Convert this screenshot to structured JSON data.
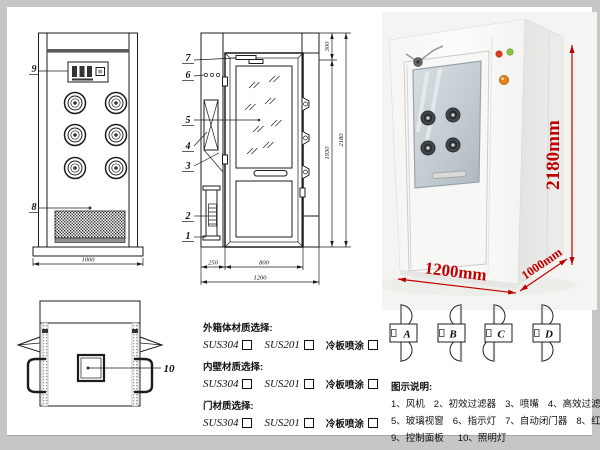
{
  "front_view": {
    "callout_9": "9",
    "callout_8": "8",
    "dim_width": "1000"
  },
  "side_view": {
    "callouts": {
      "c7": "7",
      "c6": "6",
      "c5": "5",
      "c4": "4",
      "c3": "3",
      "c2": "2",
      "c1": "1"
    },
    "dims": {
      "top": "300",
      "mid": "1930",
      "total_h": "2180",
      "left": "250",
      "door": "800",
      "total_w": "1200"
    }
  },
  "top_view": {
    "callout_10": "10"
  },
  "photo": {
    "height_label": "2180mm",
    "width_label": "1200mm",
    "depth_label": "1000mm",
    "dim_color": "#c00000"
  },
  "materials": {
    "groups": [
      {
        "title": "外箱体材质选择:",
        "opt1": "SUS304",
        "opt2": "SUS201",
        "opt3": "冷板喷涂"
      },
      {
        "title": "内壁材质选择:",
        "opt1": "SUS304",
        "opt2": "SUS201",
        "opt3": "冷板喷涂"
      },
      {
        "title": "门材质选择:",
        "opt1": "SUS304",
        "opt2": "SUS201",
        "opt3": "冷板喷涂"
      }
    ]
  },
  "door_options": {
    "a": "A",
    "b": "B",
    "c": "C",
    "d": "D"
  },
  "legend": {
    "title": "图示说明:",
    "row1": [
      "1、风机",
      "2、初效过滤器",
      "3、喷嘴",
      "4、高效过滤器"
    ],
    "row2": [
      "5、玻璃视窗",
      "6、指示灯",
      "7、自动闭门器",
      "8、红外线感应器"
    ],
    "row3": [
      "9、控制面板",
      "10、照明灯"
    ]
  }
}
